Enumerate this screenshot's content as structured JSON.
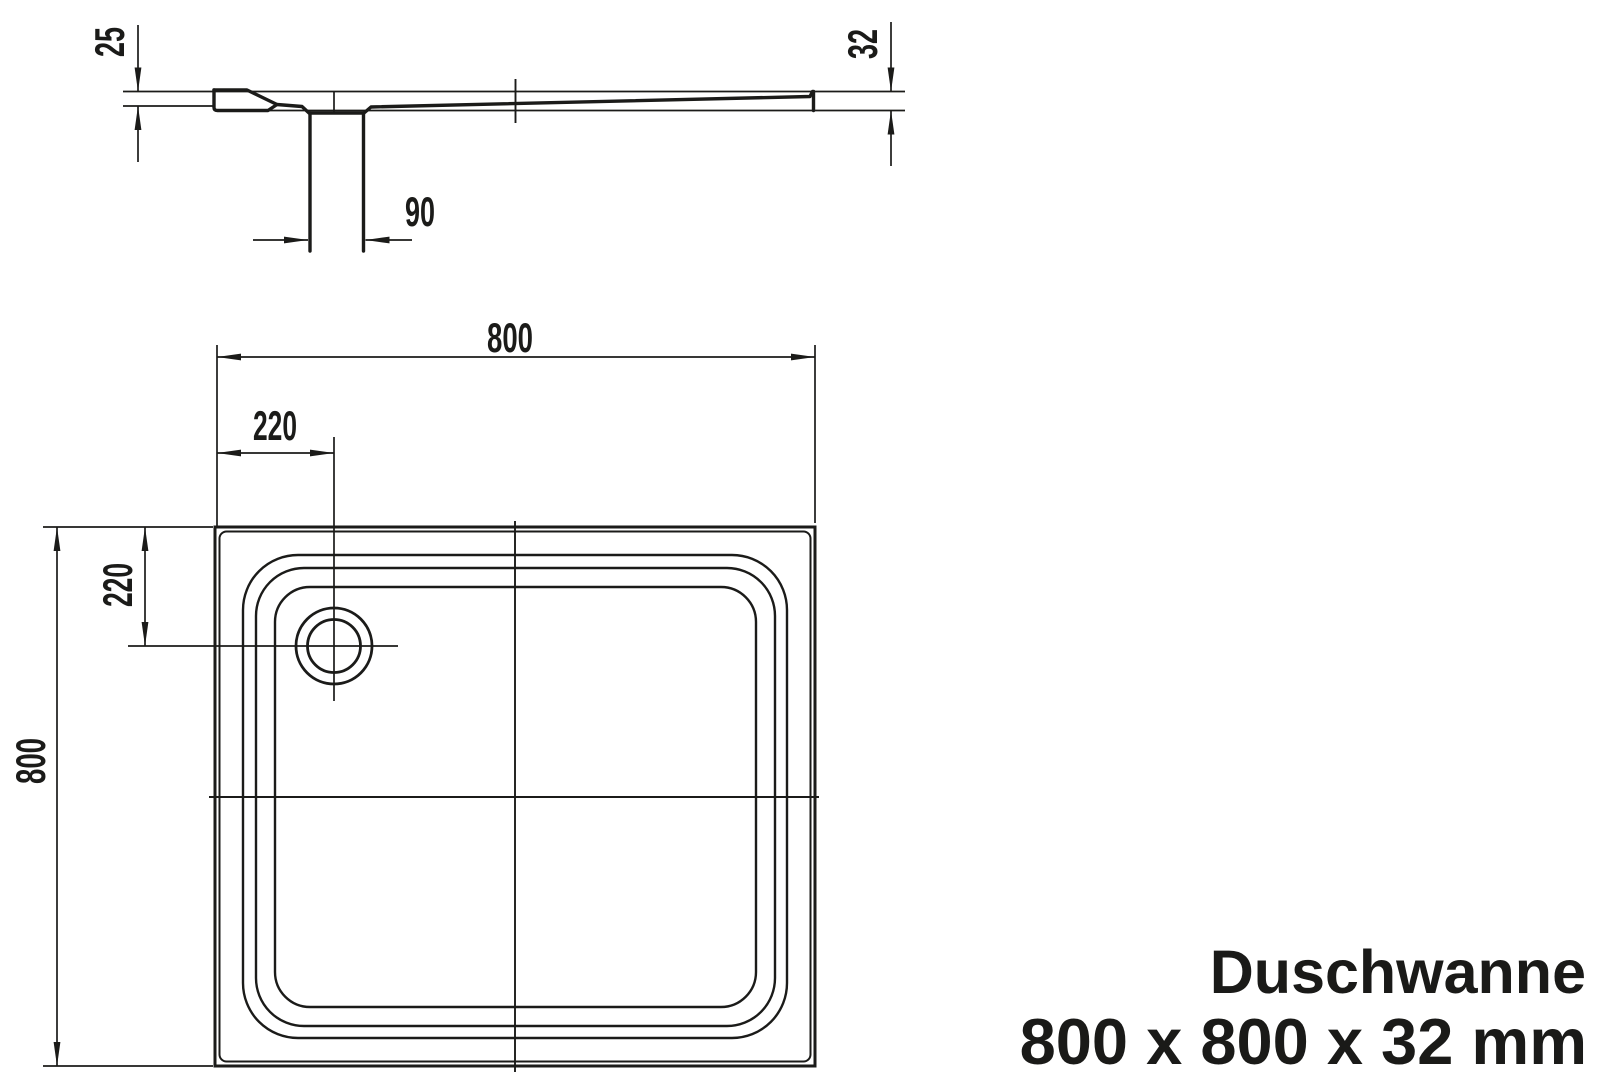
{
  "colors": {
    "background": "#ffffff",
    "line": "#1b1b19",
    "text": "#1a1a18"
  },
  "section_view": {
    "dimensions": {
      "rim_height": "25",
      "total_height": "32",
      "drain_width": "90"
    }
  },
  "plan_view": {
    "dimensions": {
      "width": "800",
      "depth": "800",
      "drain_offset_x": "220",
      "drain_offset_y": "220"
    }
  },
  "title_block": {
    "product_name": "Duschwanne",
    "size_label": "800 x 800 x 32 mm"
  }
}
